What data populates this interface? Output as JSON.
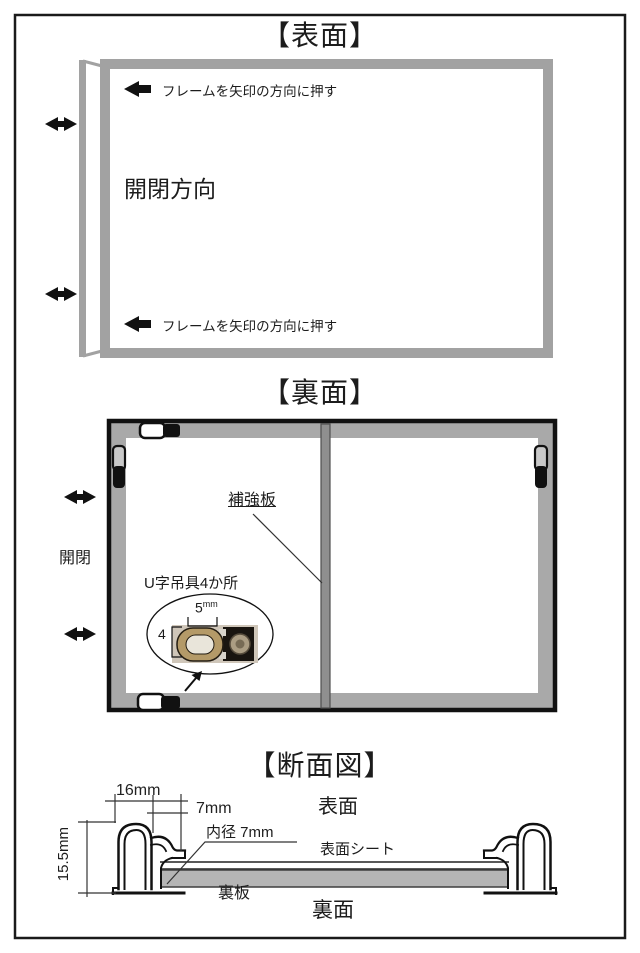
{
  "page": {
    "background": "#ffffff",
    "border_color": "#1a1a1a"
  },
  "colors": {
    "frame_gray": "#a2a2a2",
    "back_band_gray": "#a9a9a9",
    "reinforcement_bar_gray": "#8f8f8f",
    "back_board_gray": "#b5b5b5",
    "hanger_light_gray": "#c9c9c9",
    "photo_background": "#cfc6b9",
    "hanger_metal": "#b49a68"
  },
  "sections": {
    "front": {
      "title": "【表面】",
      "push_instruction_top": "フレームを矢印の方向に押す",
      "push_instruction_bottom": "フレームを矢印の方向に押す",
      "open_close_direction_label": "開閉方向",
      "icons": [
        "push-direction-arrow-icon",
        "open-close-double-arrow-icon"
      ]
    },
    "back": {
      "title": "【裏面】",
      "reinforcement_label": "補強板",
      "open_close_label": "開閉",
      "hanger_label": "U字吊具4か所",
      "hanger_width_value": "5",
      "hanger_width_unit": "mm",
      "hanger_height_value": "4",
      "icons": [
        "open-close-double-arrow-icon",
        "magnified-callout-arrow-icon"
      ]
    },
    "cross_section": {
      "title": "【断面図】",
      "dim_outer_width": "16mm",
      "dim_inner_width": "7mm",
      "dim_height": "15.5mm",
      "dim_inner_diameter": "内径 7mm",
      "front_side_label": "表面",
      "front_sheet_label": "表面シート",
      "back_board_label": "裏板",
      "back_side_label": "裏面"
    }
  }
}
